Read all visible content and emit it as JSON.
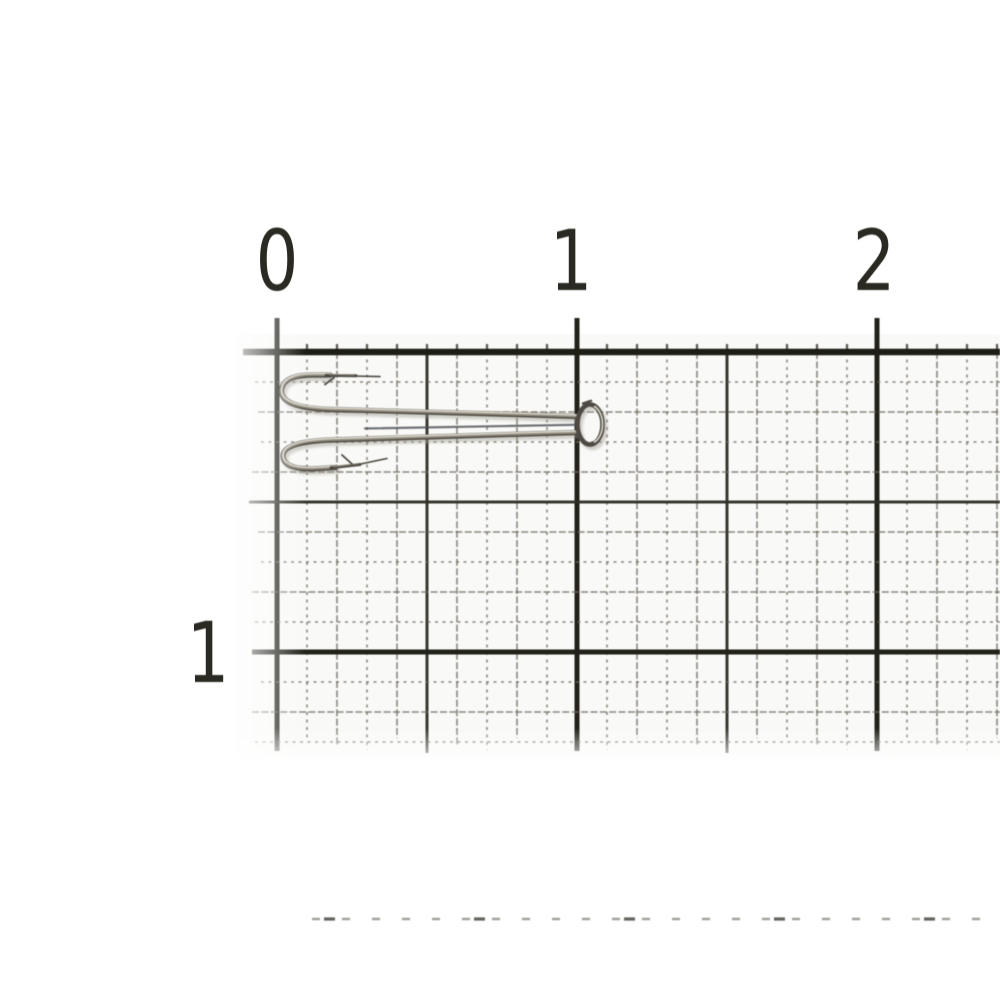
{
  "scene": {
    "subject": "double fishing hook lying on millimeter graph paper ruler",
    "background_color": "#ffffff",
    "paper_tint": "#f7f7f3"
  },
  "ruler": {
    "unit": "cm",
    "top_labels": [
      {
        "text": "0"
      },
      {
        "text": "1"
      },
      {
        "text": "2"
      }
    ],
    "side_label": {
      "text": "1"
    },
    "label_color": "#2a2a22"
  },
  "grid": {
    "mm_px": 30,
    "origin_x": 277,
    "ruler_y": 352,
    "tick_top": 318,
    "bottom_edge": 751,
    "right_edge": 1000,
    "cm_line_color": "#22221b",
    "ruler_line_color": "#1e1e17",
    "half_cm_line_color": "#2e2e27",
    "mm_line_color": "#6e6a60",
    "tick_color": "#3a3a32"
  },
  "hook": {
    "type": "double-hook",
    "wire_dark": "#4e4a43",
    "wire_mid": "#948e80",
    "wire_highlight": "#e4e1d6",
    "gap_shadow": "#4a4d52",
    "cast_shadow": "#9a968c"
  },
  "bottom_edge_marks": {
    "fine_color": "#9a9a93",
    "strong_color": "#55554f"
  }
}
